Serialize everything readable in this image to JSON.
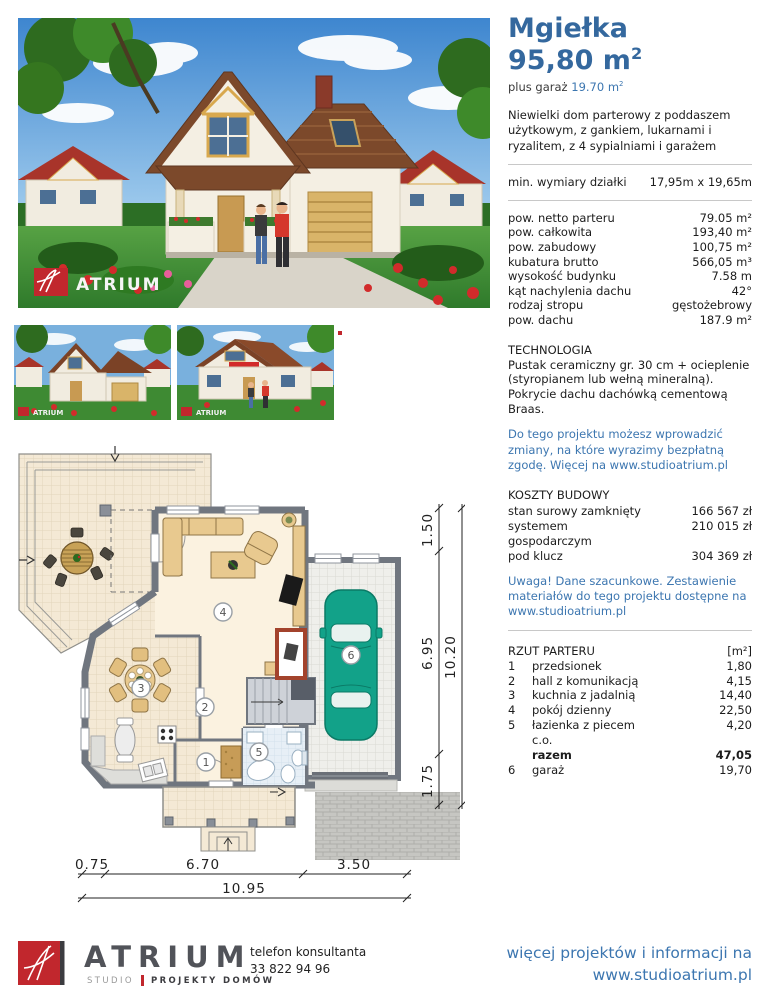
{
  "colors": {
    "accent_blue": "#34689E",
    "link_blue": "#3C76B0",
    "logo_red": "#C1272D",
    "plan_wall_gray": "#70767F",
    "car_teal": "#12A289"
  },
  "project": {
    "title": "Mgiełka",
    "area": "95,80 m",
    "area_sup": "2",
    "garage_prefix": "plus garaż ",
    "garage_area": "19.70 m",
    "garage_area_sup": "2",
    "description": "Niewielki dom parterowy z poddaszem użytkowym, z gankiem, lukarnami i ryzalitem, z 4 sypialniami i garażem"
  },
  "plot": {
    "label": "min. wymiary działki",
    "value": "17,95m x 19,65m"
  },
  "specs": [
    {
      "label": "pow. netto parteru",
      "value": "79.05 m²"
    },
    {
      "label": "pow. całkowita",
      "value": "193,40 m²"
    },
    {
      "label": "pow. zabudowy",
      "value": "100,75 m²"
    },
    {
      "label": "kubatura brutto",
      "value": "566,05 m³"
    },
    {
      "label": "wysokość budynku",
      "value": "7.58 m"
    },
    {
      "label": "kąt nachylenia dachu",
      "value": "42°"
    },
    {
      "label": "rodzaj stropu",
      "value": "gęstożebrowy"
    },
    {
      "label": "pow. dachu",
      "value": "187.9 m²"
    }
  ],
  "technology": {
    "heading": "TECHNOLOGIA",
    "text": "Pustak ceramiczny gr. 30 cm + ocieplenie (styropianem lub wełną mineralną). Pokrycie dachu dachówką cementową Braas.",
    "note": "Do tego projektu możesz wprowadzić zmiany, na które wyrazimy bezpłatną zgodę. Więcej na www.studioatrium.pl"
  },
  "costs": {
    "heading": "KOSZTY BUDOWY",
    "rows": [
      {
        "label": "stan surowy zamknięty",
        "value": "166 567 zł"
      },
      {
        "label": "systemem",
        "value": "210 015 zł"
      },
      {
        "label": "gospodarczym",
        "value": ""
      },
      {
        "label": "pod klucz",
        "value": "304 369 zł"
      }
    ],
    "note": "Uwaga! Dane szacunkowe. Zestawienie materiałów do tego projektu dostępne na www.studioatrium.pl"
  },
  "floor_list": {
    "heading": "RZUT PARTERU",
    "unit": "[m²]",
    "rows": [
      {
        "num": "1",
        "label": "przedsionek",
        "value": "1,80"
      },
      {
        "num": "2",
        "label": "hall z komunikacją",
        "value": "4,15"
      },
      {
        "num": "3",
        "label": "kuchnia z jadalnią",
        "value": "14,40"
      },
      {
        "num": "4",
        "label": "pokój dzienny",
        "value": "22,50"
      },
      {
        "num": "5",
        "label": "łazienka z piecem",
        "value": "4,20"
      },
      {
        "num": "",
        "label": "c.o.",
        "value": ""
      },
      {
        "num": "",
        "label": "razem",
        "value": "47,05",
        "bold": true
      },
      {
        "num": "6",
        "label": "garaż",
        "value": "19,70"
      }
    ]
  },
  "plan": {
    "rooms": [
      "1",
      "2",
      "3",
      "4",
      "5",
      "6"
    ],
    "dim_right": [
      "1.50",
      "6.95",
      "1.75"
    ],
    "dim_right_total": "10.20",
    "dim_bottom": [
      "0.75",
      "6.70",
      "3.50"
    ],
    "dim_bottom_total": "10.95"
  },
  "photos": {
    "watermark": "ATRIUM"
  },
  "footer": {
    "brand": "ATRIUM",
    "brand_sub_left": "STUDIO",
    "brand_sub_right": "PROJEKTY DOMÓW",
    "phone_label": "telefon konsultanta",
    "phone_number": "33 822 94 96",
    "more_line1": "więcej projektów i informacji na",
    "more_line2": "www.studioatrium.pl"
  }
}
